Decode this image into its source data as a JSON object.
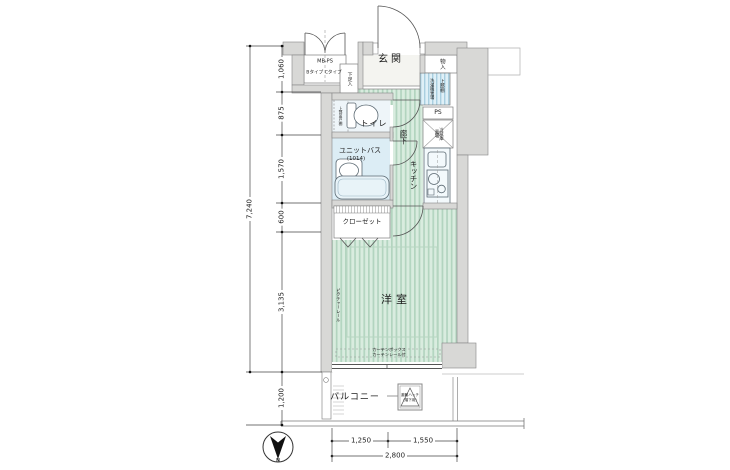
{
  "plan": {
    "rooms": {
      "genkan": "玄関",
      "storage": "物入",
      "shoe_box": "下足入",
      "mb_ps": "MB-PS",
      "mb_types": "Bタイプ Cタイプ",
      "toilet": "トイレ",
      "toilet_cabinet": "上部吊戸棚",
      "unit_bath": "ユニットバス",
      "unit_bath_size": "(1014)",
      "hallway": "廊下",
      "kitchen": "キッチン",
      "washer_shelf": "上部棚",
      "washer": "洗濯機置場",
      "ps": "PS",
      "fridge": "冷蔵庫置場",
      "closet": "クローゼット",
      "western_room": "洋室",
      "picture_rail": "ピクチャーレール",
      "curtain_box": "カーテンボックス",
      "curtain_rail": "カーテンレール付",
      "balcony": "バルコニー",
      "hatch": "避難ハッチ",
      "hatch_sub": "(階下用)"
    },
    "dimensions": {
      "total_height": "7,240",
      "segments_left": [
        "1,060",
        "875",
        "1,570",
        "600",
        "3,135",
        "1,200"
      ],
      "bottom_segments": [
        "1,250",
        "1,550"
      ],
      "bottom_total": "2,800"
    },
    "compass": {
      "north": "N"
    },
    "colors": {
      "floor_green": "#d9ecdf",
      "floor_green_stripe": "#b2d4bf",
      "floor_blue": "#dcedf5",
      "washer_blue": "#dff0f7",
      "wall_gray": "#d8d8d6",
      "line": "#555555"
    }
  }
}
